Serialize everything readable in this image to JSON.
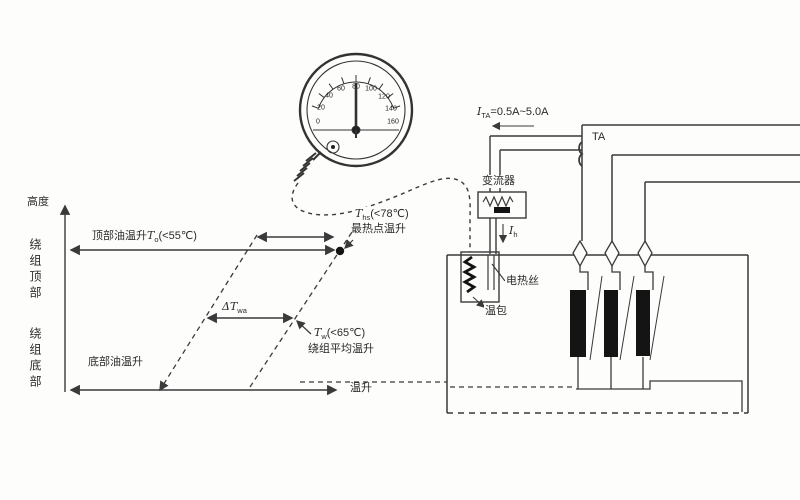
{
  "figure": {
    "axis": {
      "y_label": "高度",
      "y_top": "绕组顶部",
      "y_bottom": "绕组底部",
      "x_label": "温升"
    },
    "labels": {
      "top_oil": {
        "prefix": "顶部油温升",
        "sym": "T",
        "sub": "o",
        "cond": "(<55℃)"
      },
      "hotspot": {
        "sym": "T",
        "sub": "hs",
        "cond": "(<78℃)",
        "name": "最热点温升"
      },
      "delta": {
        "sym": "ΔT",
        "sub": "wa"
      },
      "winding_avg": {
        "sym": "T",
        "sub": "w",
        "cond": "(<65℃)",
        "name": "绕组平均温升"
      },
      "bottom_oil": "底部油温升"
    },
    "thermometer": {
      "scale": [
        "0",
        "20",
        "40",
        "60",
        "80",
        "100",
        "120",
        "140",
        "160"
      ]
    },
    "circuit": {
      "ta_current": {
        "sym": "I",
        "sub": "TA",
        "value": "=0.5A~5.0A"
      },
      "ta": "TA",
      "converter": "变流器",
      "heater_current": {
        "sym": "I",
        "sub": "h"
      },
      "heater": "电热丝",
      "bulb": "温包"
    },
    "colors": {
      "ink": "#3a3a3a",
      "winding": "#141414"
    }
  }
}
